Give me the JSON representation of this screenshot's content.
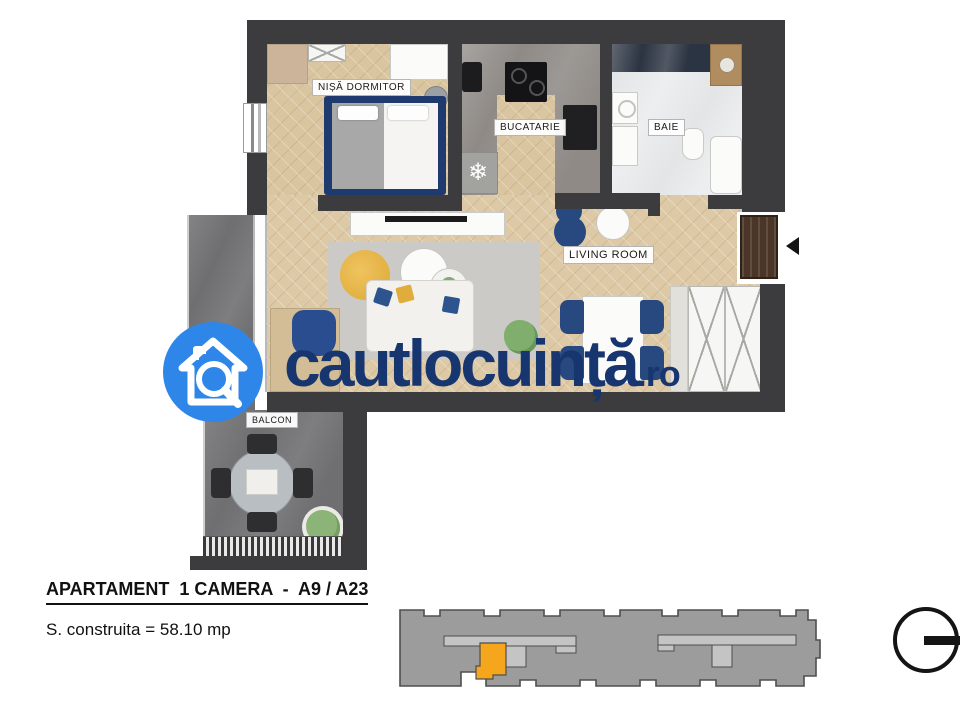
{
  "rooms": {
    "bedroom": "NIȘĂ DORMITOR",
    "kitchen": "BUCATARIE",
    "bathroom": "BAIE",
    "living": "LIVING ROOM",
    "balcony": "BALCON"
  },
  "watermark": {
    "brand": "cautlocuință",
    "tld": ".ro",
    "logo_color": "#2e86e9",
    "text_color": "#17356e"
  },
  "details": {
    "title": "APARTAMENT  1 CAMERA  -  A9 / A23",
    "area": "S. construita = 58.10 mp"
  },
  "site_plan": {
    "building_color": "#9c9c9c",
    "corridor_color": "#c4c4c4",
    "highlight_color": "#f6a61d",
    "outline_color": "#4e4e4e"
  },
  "icons": {
    "fridge": "❄"
  }
}
